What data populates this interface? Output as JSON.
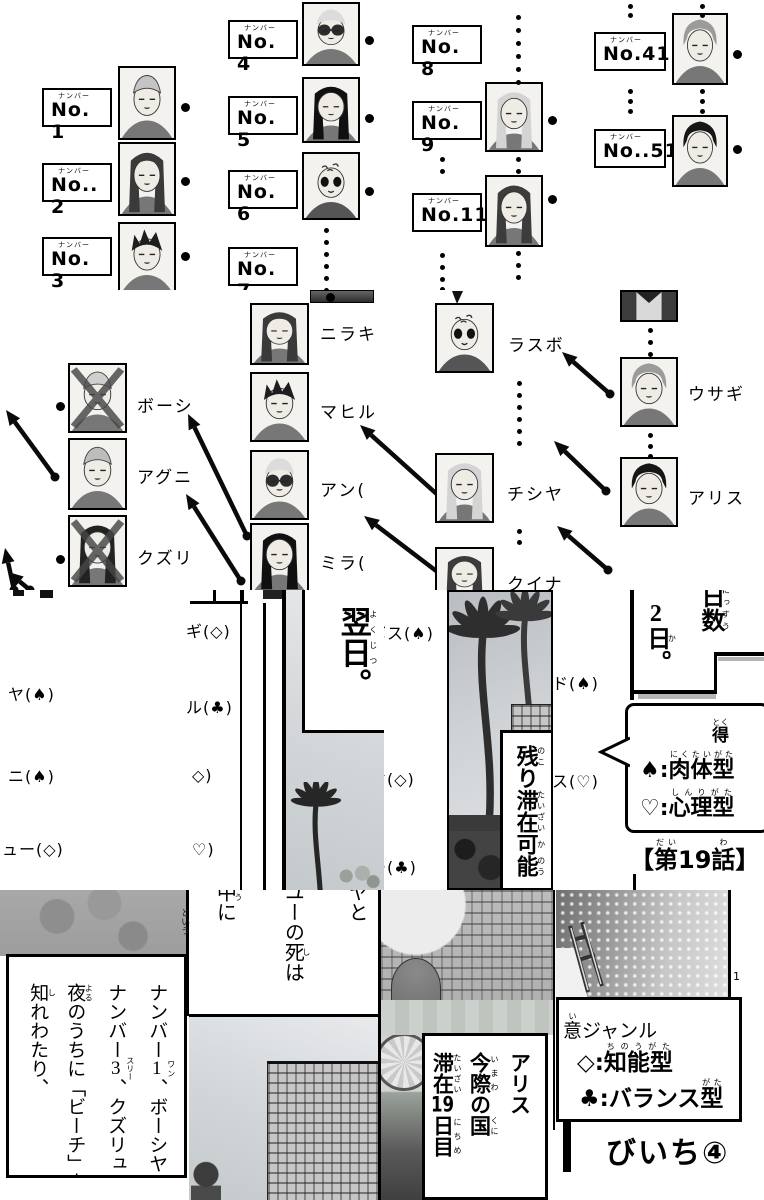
{
  "colors": {
    "ink": "#000000",
    "paper": "#ffffff"
  },
  "chart": {
    "number_furigana": "ナンバー",
    "numbers": [
      "No. 1",
      "No.. 2",
      "No. 3",
      "No. 4",
      "No. 5",
      "No. 6",
      "No. 7",
      "No. 8",
      "No. 9",
      "No.11",
      "No.41",
      "No..51"
    ],
    "names": {
      "boshi": "ボーシ",
      "aguni": "アグニ",
      "kuzuri": "クズリ",
      "niraki": "ニラキ",
      "mahiru": "マヒル",
      "an": "アン(",
      "mira": "ミラ(",
      "rasubo": "ラスボ",
      "chishiya": "チシヤ",
      "kuina": "クイナ",
      "usagi": "ウサギ",
      "arisu": "アリス"
    }
  },
  "frag": {
    "left": [
      "ヤ(♠)",
      "ニ(♠)",
      "ュー(◇)"
    ],
    "mid": [
      "ギ(◇)",
      "ル(♣)",
      "◇)",
      "♡)"
    ],
    "center": [
      "ボス(♠)",
      "ヤ(◇)",
      "ー(♣)"
    ],
    "right": [
      "ド(♠)",
      "ス(♡)"
    ],
    "seam": "という",
    "maru": "。"
  },
  "panels": {
    "yokujitsu": {
      "k1": "翌",
      "f1": "よく",
      "k2": "日",
      "f2": "じつ",
      "k3": "。"
    },
    "nokori": {
      "k1": "残",
      "f1": "のこ",
      "k2": "り",
      "k3": "滞在",
      "f3": "たいざい",
      "k4": "可",
      "f4": "か",
      "k5": "能",
      "f5": "のう"
    },
    "nissu": {
      "label": "日数",
      "label_f": "にっすう",
      "v1": "2",
      "v2": "日",
      "v2_f": "か",
      "v3": "。"
    },
    "bubble": {
      "toku": "得",
      "toku_f": "とく",
      "spade": "♠:",
      "spade_word": "肉体型",
      "spade_f": "にくたいがた",
      "heart": "♡:",
      "heart_word": "心理型",
      "heart_f": "しんりがた"
    },
    "episode": {
      "open": "【",
      "dai": "第",
      "dai_f": "だい",
      "num": "19",
      "wa": "話",
      "wa_f": "わ",
      "close": "】"
    }
  },
  "bottom": {
    "p1": {
      "c1a": "ナンバー",
      "c1b": "1",
      "c1bf": "ワン",
      "c1c": "、ボーシヤ",
      "c2a": "ナンバー",
      "c2b": "3",
      "c2bf": "スリー",
      "c2c": "、クズリュ",
      "c3a": "夜",
      "c3af": "よる",
      "c3b": "のうちに「ビーチ」中",
      "c4a": "知",
      "c4af": "し",
      "c4b": "れわたり、"
    },
    "p2": {
      "c1": "ヤと",
      "c2a": "ユーの",
      "c2b": "死",
      "c2bf": "し",
      "c2c": "は",
      "c3a": "中",
      "c3af": "ゅう",
      "c3b": "に"
    },
    "p3": {
      "c1": "アリス",
      "c2a": "今際",
      "c2af": "いまわ",
      "c2b": "の",
      "c2c": "国",
      "c2cf": "くに",
      "c3a": "滞在",
      "c3af": "たいざい",
      "c3b": "19",
      "c3c": "日目",
      "c3cf": "にちめ"
    },
    "p4": {
      "genre_a": "意",
      "genre_af": "い",
      "genre_b": "ジャンル",
      "dia": "◇:",
      "dia_word": "知能型",
      "dia_f": "ちのうがた",
      "club": "♣:",
      "club_word": "バランス",
      "club_word2": "型",
      "club_f": "がた",
      "title": "びいち④",
      "page_no": "1"
    }
  }
}
